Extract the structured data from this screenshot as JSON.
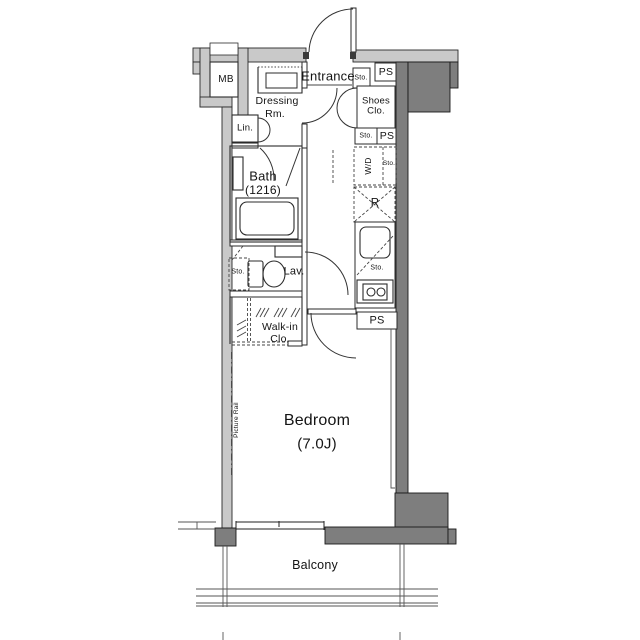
{
  "title": "One-room apartment floor plan",
  "colors": {
    "wall_light": "#c9c9c9",
    "wall_dark": "#7e7e7e",
    "line": "#141414"
  },
  "rooms": {
    "mb": "MB",
    "entrance": "Entrance",
    "shoes_line1": "Shoes",
    "shoes_line2": "Clo.",
    "dressing_line1": "Dressing",
    "dressing_line2": "Rm.",
    "lin": "Lin.",
    "bath": "Bath",
    "bath_size": "(1216)",
    "lav": "Lav.",
    "walkin_line1": "Walk-in",
    "walkin_line2": "Clo.",
    "bedroom": "Bedroom",
    "bedroom_size": "(7.0J)",
    "balcony": "Balcony"
  },
  "fixtures": {
    "ps": "PS",
    "sto": "Sto.",
    "wd": "W/D",
    "fridge": "R",
    "picture_rail": "Picture Rail"
  }
}
